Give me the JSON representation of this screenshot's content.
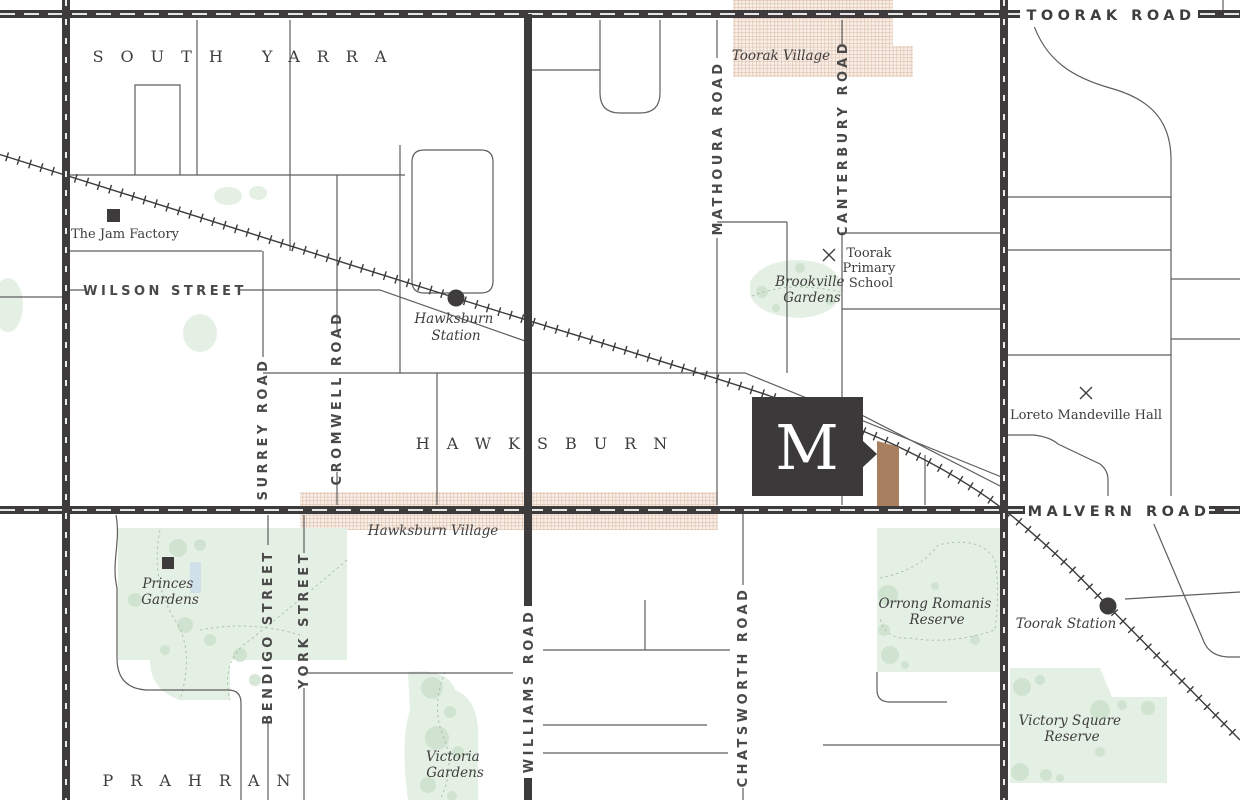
{
  "map": {
    "suburbs": {
      "south_yarra": "SOUTH YARRA",
      "hawksburn": "HAWKSBURN",
      "prahran": "PRAHRAN"
    },
    "major_roads": {
      "toorak_road": "TOORAK ROAD",
      "malvern_road": "MALVERN ROAD"
    },
    "streets": {
      "wilson_street": "WILSON STREET",
      "surrey_road": "SURREY ROAD",
      "cromwell_road": "CROMWELL ROAD",
      "mathoura_road": "MATHOURA ROAD",
      "canterbury_road": "CANTERBURY ROAD",
      "williams_road": "WILLIAMS ROAD",
      "chatsworth_road": "CHATSWORTH ROAD",
      "bendigo_street": "BENDIGO STREET",
      "york_street": "YORK STREET"
    },
    "villages": {
      "toorak_village": "Toorak Village",
      "hawksburn_village": "Hawksburn Village"
    },
    "stations": {
      "hawksburn": {
        "line1": "Hawksburn",
        "line2": "Station"
      },
      "toorak": "Toorak Station"
    },
    "parks": {
      "brookville": {
        "line1": "Brookville",
        "line2": "Gardens"
      },
      "princes": {
        "line1": "Princes",
        "line2": "Gardens"
      },
      "victoria": {
        "line1": "Victoria",
        "line2": "Gardens"
      },
      "orrong_romanis": {
        "line1": "Orrong Romanis",
        "line2": "Reserve"
      },
      "victory_square": {
        "line1": "Victory Square",
        "line2": "Reserve"
      }
    },
    "landmarks": {
      "jam_factory": "The Jam Factory",
      "toorak_primary": {
        "line1": "Toorak",
        "line2": "Primary",
        "line3": "School"
      },
      "loreto": "Loreto Mandeville Hall"
    },
    "logo": {
      "letter": "M"
    },
    "colors": {
      "road_dark": "#3d3b3c",
      "street_line": "#5f5d5e",
      "park_fill": "#e4f0e4",
      "village_hatch_line": "#dcbca6",
      "village_hatch_bg": "#f8efe8",
      "site_brown": "#a9805f",
      "text": "#3f3d3e"
    }
  }
}
